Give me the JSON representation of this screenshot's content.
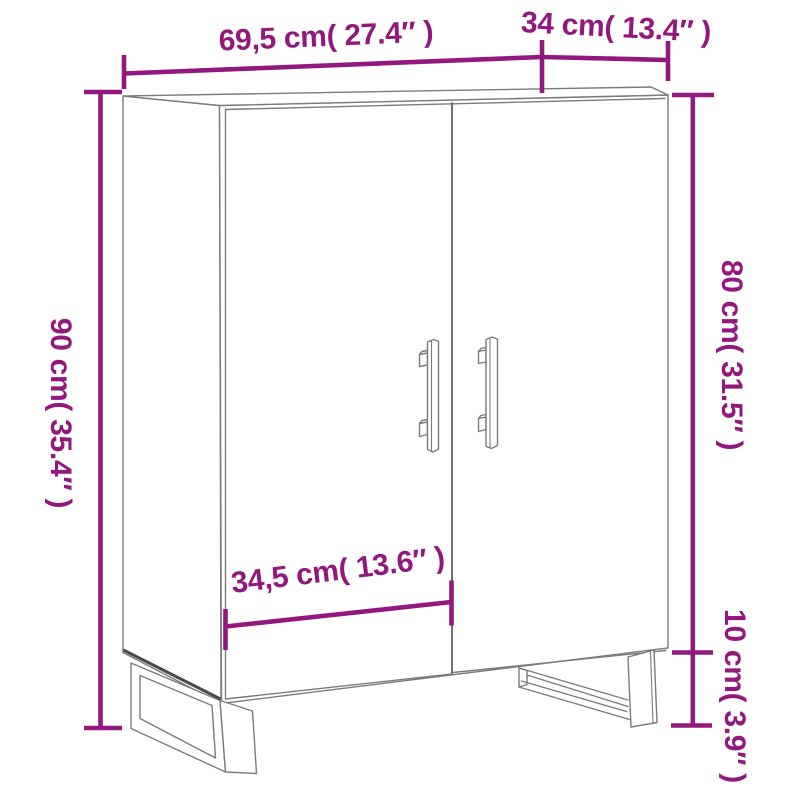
{
  "page": {
    "background": "#ffffff"
  },
  "diagram": {
    "kind": "furniture-dimension-diagram",
    "subject": "two-door sideboard on metal sled legs",
    "accent_color": "#93187E",
    "furniture_line_color": "#7b7b7b",
    "dimensions": {
      "width": {
        "label": "69,5 cm( 27.4″ )",
        "cm": "69,5",
        "inches": "27.4"
      },
      "depth": {
        "label": "34 cm( 13.4″ )",
        "cm": "34",
        "inches": "13.4"
      },
      "height": {
        "label": "90 cm( 35.4″ )",
        "cm": "90",
        "inches": "35.4"
      },
      "body_height": {
        "label": "80 cm( 31.5″ )",
        "cm": "80",
        "inches": "31.5"
      },
      "leg_height": {
        "label": "10 cm( 3.9″ )",
        "cm": "10",
        "inches": "3.9"
      },
      "door_width": {
        "label": "34,5 cm( 13.6″ )",
        "cm": "34,5",
        "inches": "13.6"
      }
    }
  }
}
